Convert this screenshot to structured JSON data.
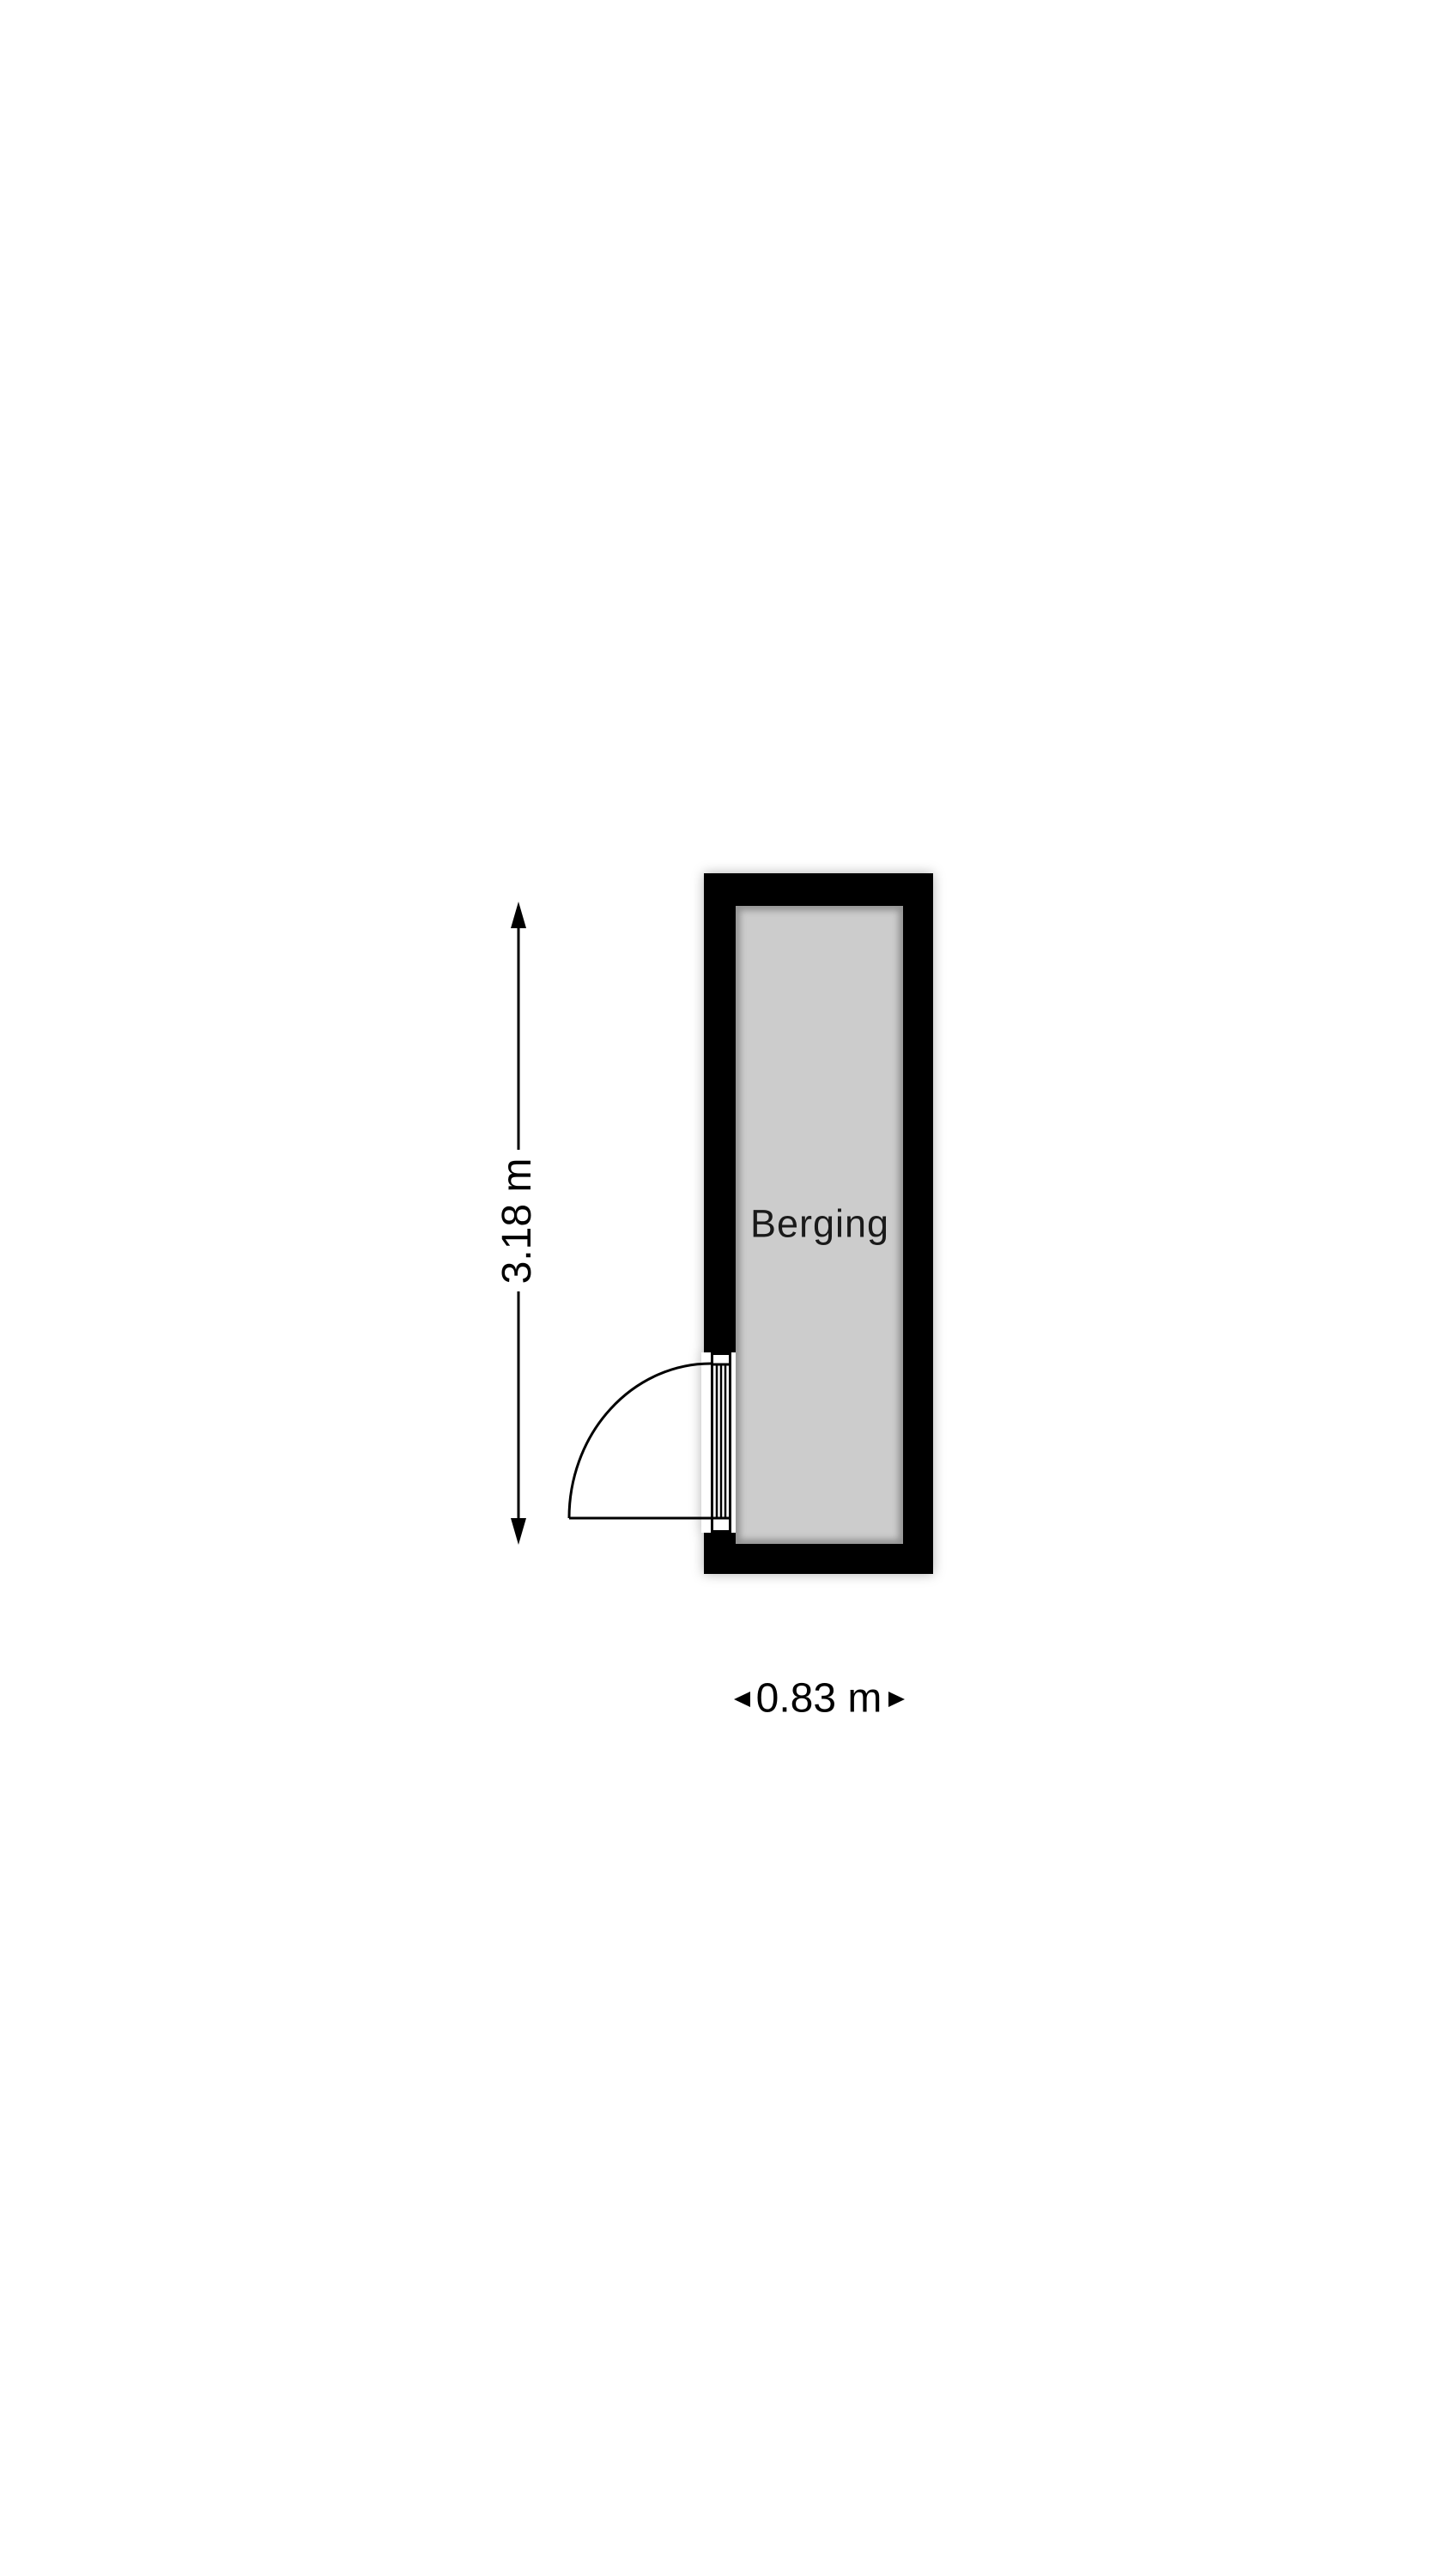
{
  "floorplan": {
    "title": "storage room floor plan",
    "background_color": "#ffffff",
    "room": {
      "label": "Berging",
      "wall_color": "#000000",
      "floor_color": "#cccccc",
      "door": {
        "symbol": "single-swing-door",
        "wall_side": "left",
        "swing": "opens outward to lower-left"
      }
    },
    "dimensions": {
      "height": {
        "label": "3.18 m",
        "value_m": 3.18,
        "orientation": "vertical",
        "arrow_icons": [
          "arrow-up-icon",
          "arrow-down-icon"
        ]
      },
      "width": {
        "label": "0.83 m",
        "value_m": 0.83,
        "orientation": "horizontal",
        "arrow_icons": [
          "arrow-left-icon",
          "arrow-right-icon"
        ]
      }
    },
    "line_color": "#000000"
  }
}
